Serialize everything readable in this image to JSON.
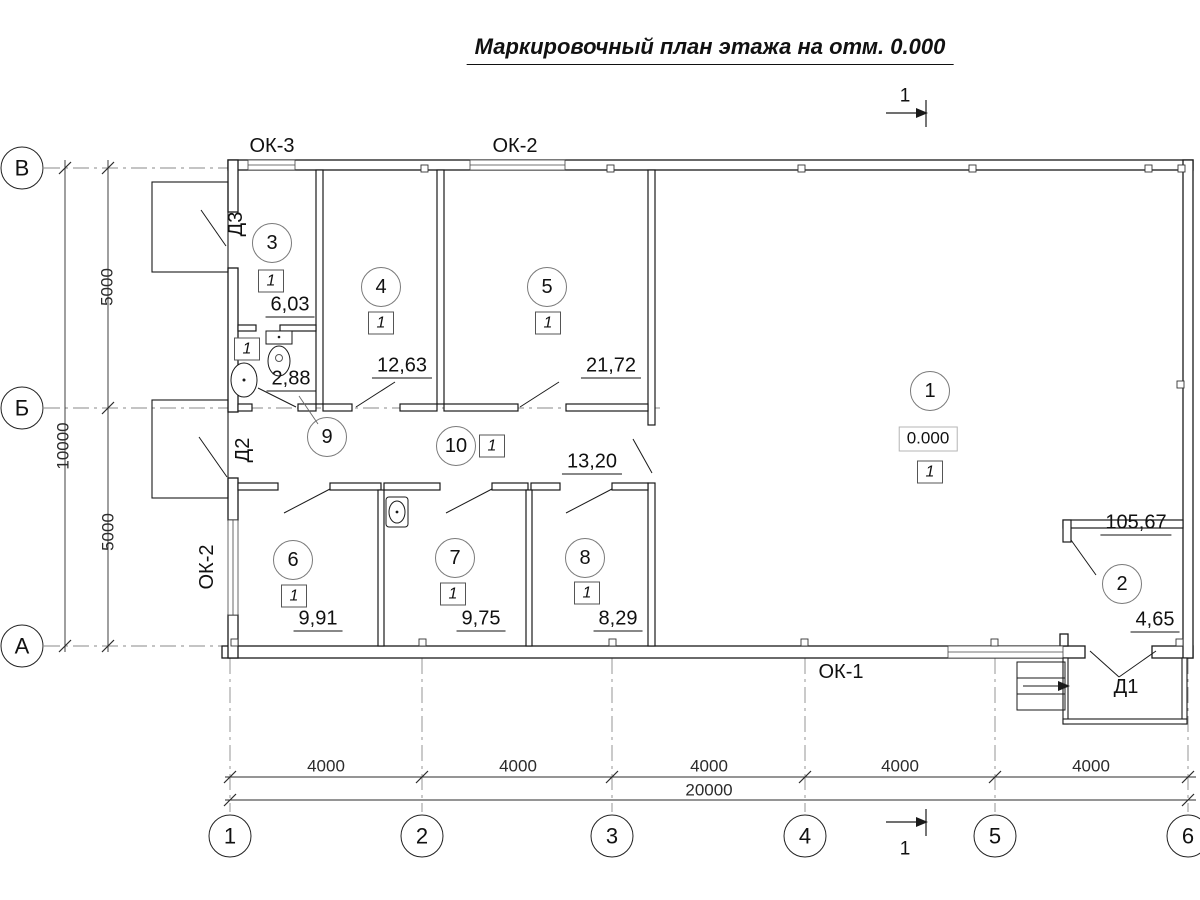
{
  "title": "Маркировочный план этажа на отм. 0.000",
  "section_mark_top": "1",
  "section_mark_bottom": "1",
  "axes": {
    "vertical": [
      "В",
      "Б",
      "А"
    ],
    "horizontal": [
      "1",
      "2",
      "3",
      "4",
      "5",
      "6"
    ]
  },
  "dimensions": {
    "bottom_segments": [
      "4000",
      "4000",
      "4000",
      "4000",
      "4000"
    ],
    "bottom_total": "20000",
    "left_segments": [
      "5000",
      "5000"
    ],
    "left_total": "10000"
  },
  "labels": {
    "window_ok3_top": "ОК-3",
    "window_ok2_top": "ОК-2",
    "window_ok2_left": "ОК-2",
    "window_ok1_bottom": "ОК-1",
    "door_d1": "Д1",
    "door_d2": "Д2",
    "door_d3": "Д3"
  },
  "rooms": [
    {
      "number": "1",
      "area": "105,67",
      "finish": "1",
      "elevation": "0.000"
    },
    {
      "number": "2",
      "area": "4,65"
    },
    {
      "number": "3",
      "area": "6,03",
      "finish": "1"
    },
    {
      "number": "4",
      "area": "12,63",
      "finish": "1"
    },
    {
      "number": "5",
      "area": "21,72",
      "finish": "1"
    },
    {
      "number": "6",
      "area": "9,91",
      "finish": "1"
    },
    {
      "number": "7",
      "area": "9,75",
      "finish": "1"
    },
    {
      "number": "8",
      "area": "8,29",
      "finish": "1"
    },
    {
      "number": "9",
      "area": "2,88",
      "finish": "1"
    },
    {
      "number": "10",
      "area": "13,20",
      "finish": "1"
    }
  ]
}
